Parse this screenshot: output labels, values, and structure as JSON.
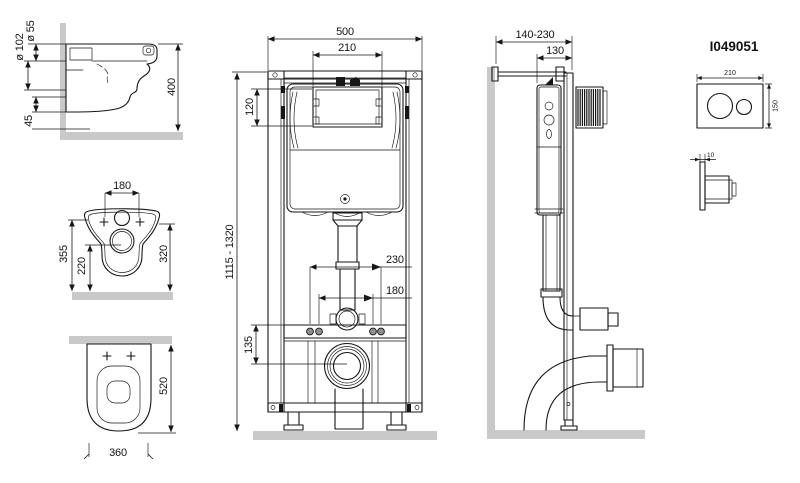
{
  "title": "Wall-hung toilet installation frame dimensional drawing",
  "dims": {
    "pan_flush": "ø 55",
    "pan_outlet": "ø 102",
    "pan_height": "400",
    "pan_offset": "45",
    "top_bolts": "180",
    "top_depth": "355",
    "top_outlet": "220",
    "top_rim": "320",
    "plan_length": "520",
    "plan_width": "360",
    "frame_width": "500",
    "frame_window_w": "210",
    "frame_window_h": "120",
    "frame_height": "1115 - 1320",
    "frame_fix_outer": "230",
    "frame_fix_inner": "180",
    "frame_outlet_h": "135",
    "side_depth": "140-230",
    "side_cistern": "130",
    "plate_model": "I049051",
    "plate_w": "210",
    "plate_h": "150",
    "plate_t": "10"
  }
}
